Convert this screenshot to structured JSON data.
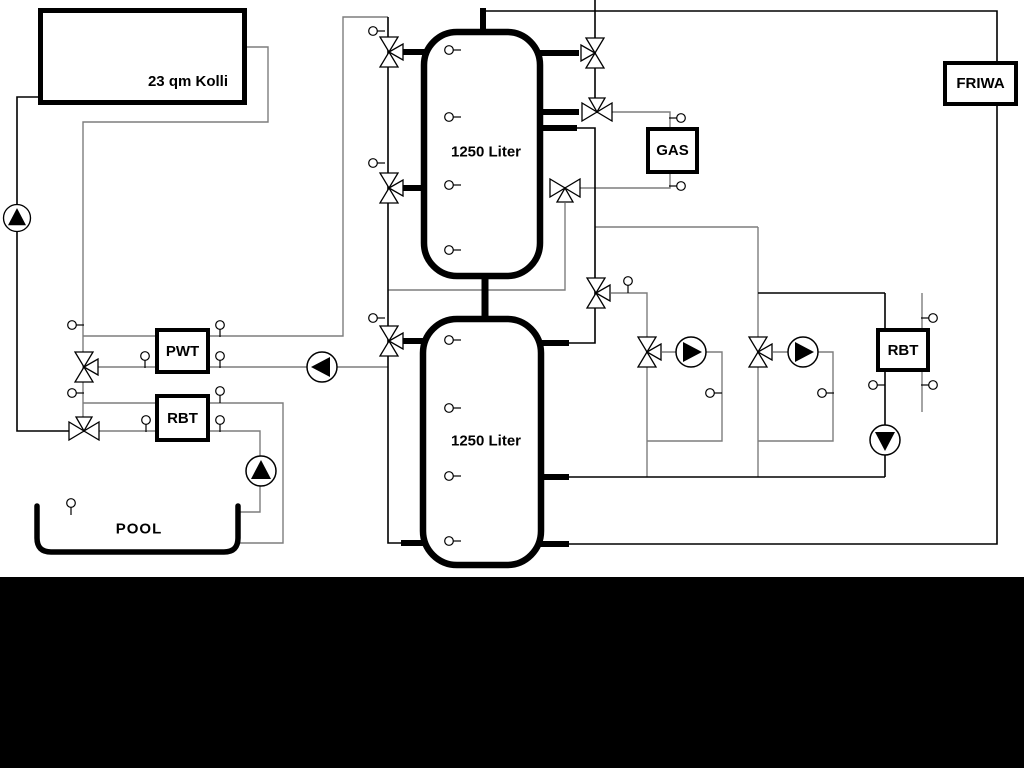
{
  "labels": {
    "collector": "23 qm Kolli",
    "tank_top": "1250 Liter",
    "tank_bottom": "1250 Liter",
    "gas": "GAS",
    "friwa": "FRIWA",
    "pwt": "PWT",
    "rbt_left": "RBT",
    "rbt_right": "RBT",
    "pool": "POOL"
  },
  "colors": {
    "background": "#ffffff",
    "letterbox_bottom": "#000000",
    "pipe_primary": "#000000",
    "pipe_secondary": "#7d7d7d",
    "component_fill": "#ffffff",
    "component_border": "#000000"
  },
  "icons": {
    "pump": "circle with solid triangle showing flow direction",
    "three_way_valve": "double-triangle bowtie with third port triangle",
    "sensor": "small circle with stem"
  },
  "symbol_inventory": {
    "pumps": [
      "pump-up-solar",
      "pump-left-pwt",
      "pump-up-pool",
      "pump-right-circuit1",
      "pump-right-circuit2",
      "pump-down-rbt"
    ],
    "valves": 11,
    "sensors": 30,
    "tanks": 2
  }
}
